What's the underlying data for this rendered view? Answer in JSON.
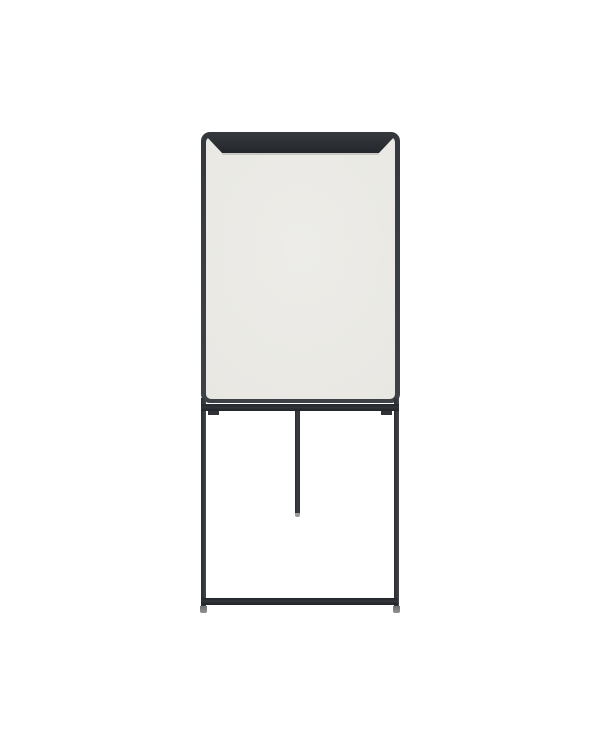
{
  "scene": {
    "type": "product-photo",
    "object": "flipchart-whiteboard-easel",
    "description": "Freestanding flipchart easel with an off-white dry-erase board, dark charcoal rounded frame, paper clamp bar across the top, two front legs with a lower crossbar, a short rear/center support pole, and small gray feet, photographed on a plain white background",
    "orientation": "front view, centered"
  },
  "colors": {
    "background": "#ffffff",
    "board_surface": "#e9e8e3",
    "frame": "#3a3d42",
    "clamp": "#2a2d32",
    "legs": "#35383d",
    "tray": "#2f3237",
    "feet": "#8e9092",
    "pole_tip": "#9a9b9d"
  }
}
